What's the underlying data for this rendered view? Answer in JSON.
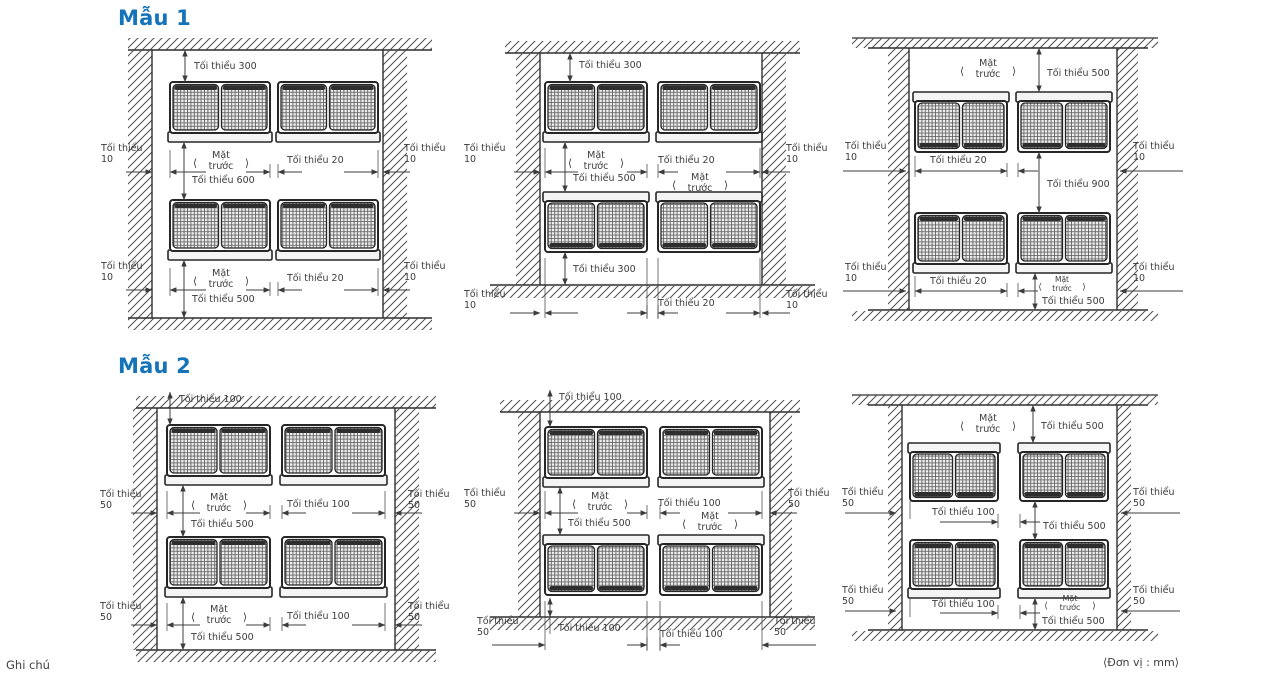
{
  "page": {
    "footer_note": "Ghi chú",
    "unit_note": "⟨Đơn vị : mm⟩"
  },
  "glyphs": {
    "angle_left": "⟨",
    "angle_right": "⟩"
  },
  "colors": {
    "accent": "#1573b9",
    "line": "#3c3c3c"
  },
  "sections": [
    {
      "title": "Mẫu 1",
      "diagrams": [
        {
          "name": "walls-four-sides-two-rows",
          "top_clearance": "Tối thiểu 300",
          "side_clearance": "Tối thiểu 10",
          "unit_gap": "Tối thiểu 20",
          "row_gap": "Tối thiểu 600",
          "bottom_clearance": "Tối thiểu 500",
          "front_label": "Mặt trước"
        },
        {
          "name": "walls-three-sides-open-bottom",
          "top_clearance": "Tối thiểu 300",
          "side_clearance": "Tối thiểu 10",
          "unit_gap": "Tối thiểu 20",
          "row_gap": "Tối thiểu 500",
          "bottom_clearance": "Tối thiểu 300",
          "front_label": "Mặt trước",
          "below_left": "Tối thiểu 10",
          "below_center": "Tối thiểu 20",
          "below_right": "Tối thiểu 10"
        },
        {
          "name": "ceiling-walls-floor",
          "top_clearance": "Tối thiểu 500",
          "side_clearance": "Tối thiểu 10",
          "unit_gap": "Tối thiểu 20",
          "row_gap": "Tối thiểu 900",
          "bottom_clearance": "Tối thiểu 500",
          "front_label": "Mặt trước"
        }
      ]
    },
    {
      "title": "Mẫu 2",
      "diagrams": [
        {
          "name": "walls-four-sides-two-rows",
          "top_clearance": "Tối thiểu 100",
          "side_clearance": "Tối thiểu 50",
          "unit_gap": "Tối thiểu 100",
          "row_gap": "Tối thiểu 500",
          "bottom_clearance": "Tối thiểu 500",
          "front_label": "Mặt trước"
        },
        {
          "name": "walls-three-sides-open-bottom",
          "top_clearance": "Tối thiểu 100",
          "side_clearance": "Tối thiểu 50",
          "unit_gap": "Tối thiểu 100",
          "row_gap": "Tối thiểu 500",
          "bottom_clearance": "Tối thiểu 100",
          "front_label": "Mặt trước",
          "below_left": "Tối thiểu 50",
          "below_center": "Tối thiểu 100",
          "below_right": "Tối thiểu 50"
        },
        {
          "name": "ceiling-walls-floor",
          "top_clearance": "Tối thiểu 500",
          "side_clearance": "Tối thiểu 50",
          "unit_gap": "Tối thiểu 100",
          "row_gap": "Tối thiểu 500",
          "bottom_clearance": "Tối thiểu 500",
          "front_label": "Mặt trước"
        }
      ]
    }
  ]
}
